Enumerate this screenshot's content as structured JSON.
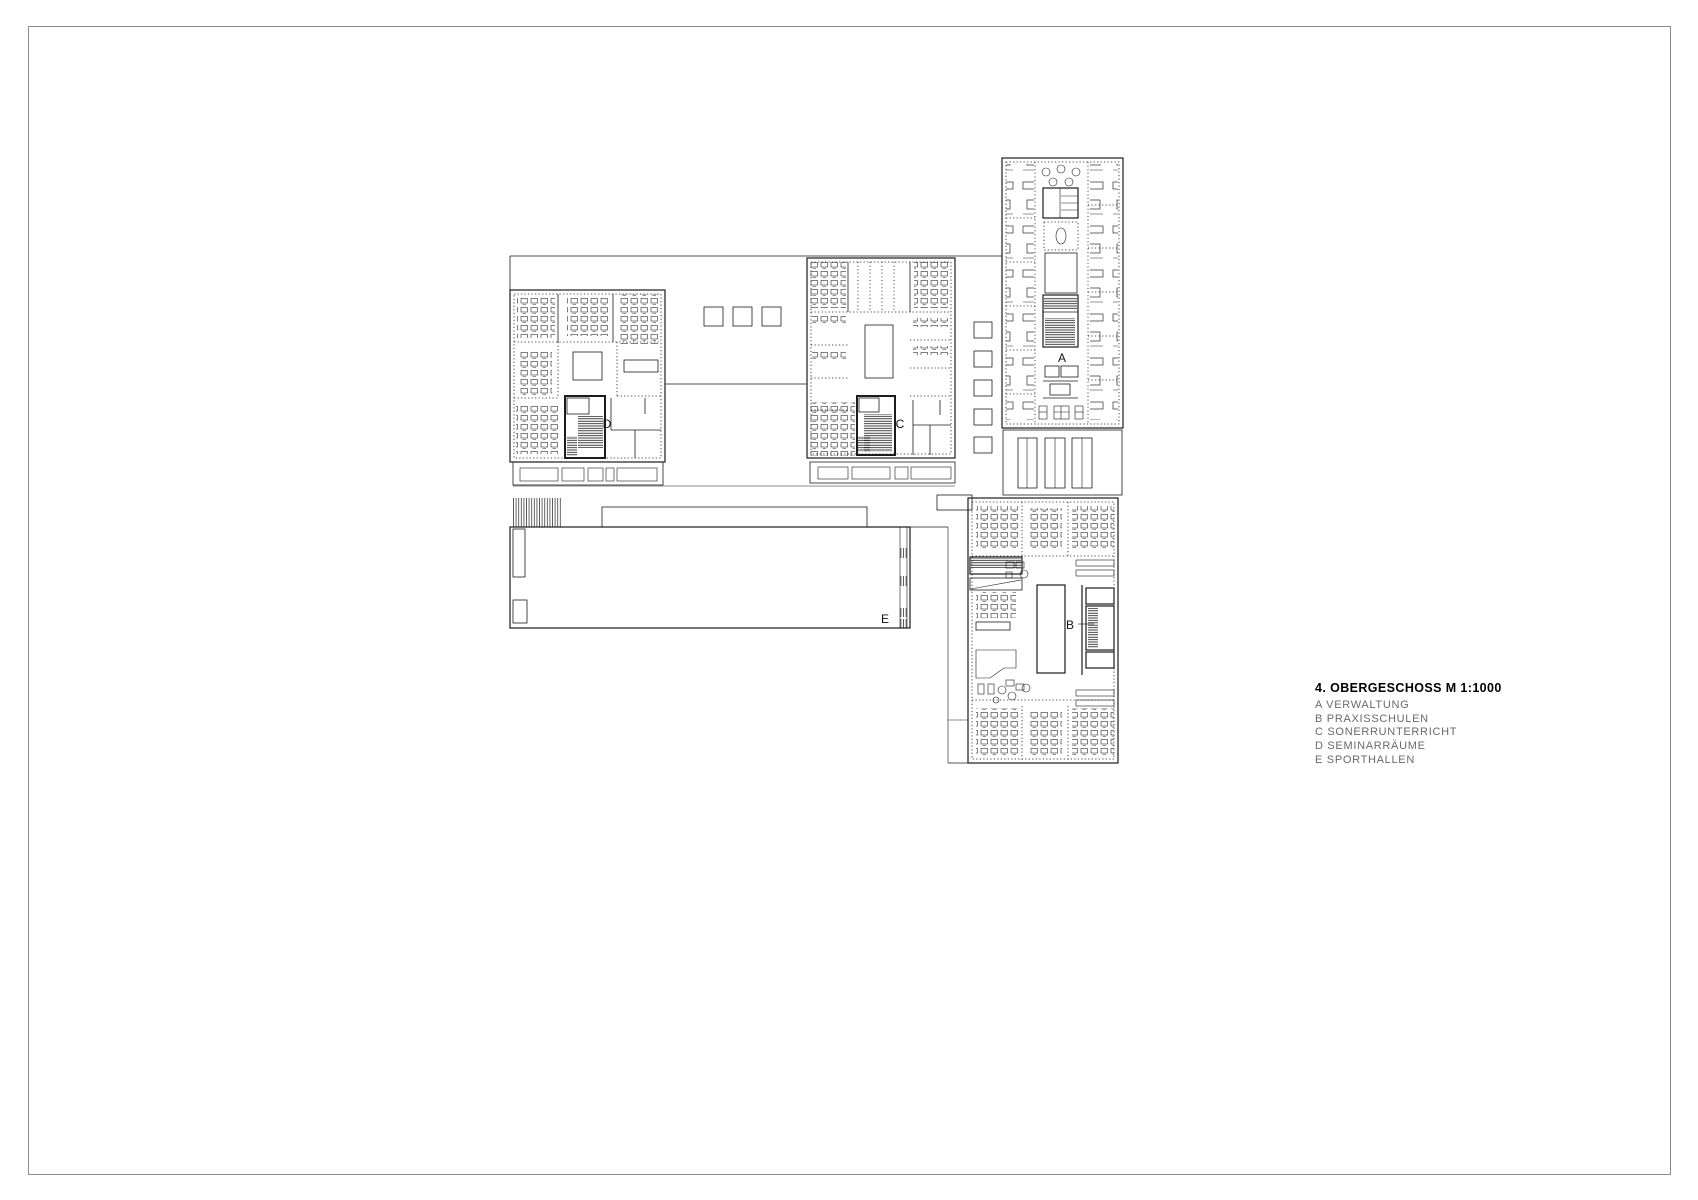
{
  "sheet": {
    "background": "#ffffff",
    "border_color": "#8c8c8c"
  },
  "drawing": {
    "line_color": "#1c1c1c",
    "labels": {
      "a": "A",
      "b": "B",
      "c": "C",
      "d": "D",
      "e": "E"
    }
  },
  "legend": {
    "title": "4. OBERGESCHOSS M 1:1000",
    "items": [
      {
        "key": "A",
        "label": "A VERWALTUNG"
      },
      {
        "key": "B",
        "label": "B PRAXISSCHULEN"
      },
      {
        "key": "C",
        "label": "C SONERRUNTERRICHT"
      },
      {
        "key": "D",
        "label": "D SEMINARRÄUME"
      },
      {
        "key": "E",
        "label": "E SPORTHALLEN"
      }
    ]
  }
}
